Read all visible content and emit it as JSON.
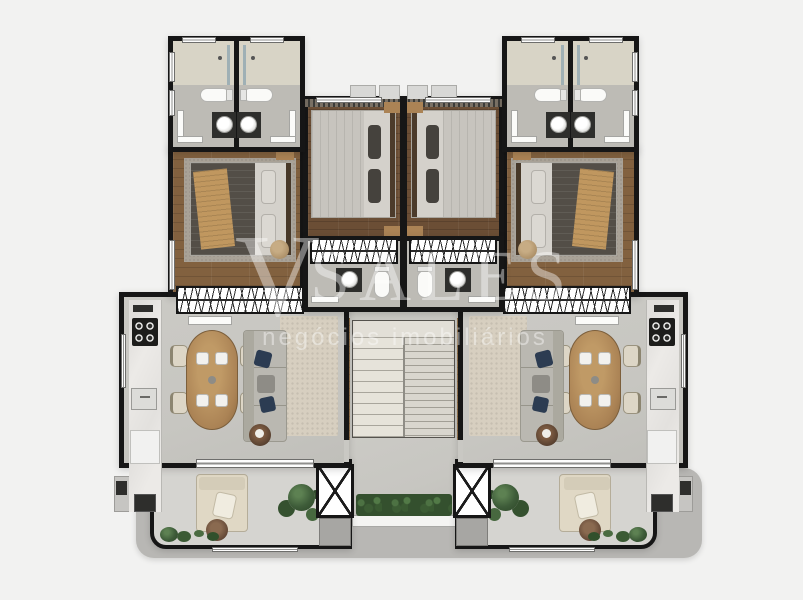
{
  "watermark": {
    "logo_mark": "V",
    "logo_text": "SALES",
    "tagline": "negócios imobiliários"
  },
  "colors": {
    "background": "#f2f2f1",
    "wall": "#161616",
    "wood_floor": "#82613f",
    "wood_floor_dark": "#6b4e35",
    "bedroom_rug": "#a9a297",
    "gray_floor": "#c7c6c1",
    "bath_floor": "#bdbbb5",
    "shower_floor": "#d8d4c6",
    "marble": "#eceae7",
    "living_rug": "#d7cfc0",
    "balcony_floor": "#d5d4d0",
    "paving": "#b8b7b4",
    "hedge_green": "#34502e",
    "plant_green": "#3e5c39",
    "sofa_gray": "#bab8b1",
    "lounge_cream": "#e0d8c5",
    "bed_dark": "#534e47",
    "bed_light": "#d4d1cb",
    "throw_tan": "#c0975f",
    "wood_furniture": "#ab8355",
    "panel_wood": "#96754f",
    "navy": "#2c3c52",
    "fixture_dark": "#2e2e2c",
    "stair_tread": "#e2dfd7",
    "watermark_white": "#ffffff"
  }
}
